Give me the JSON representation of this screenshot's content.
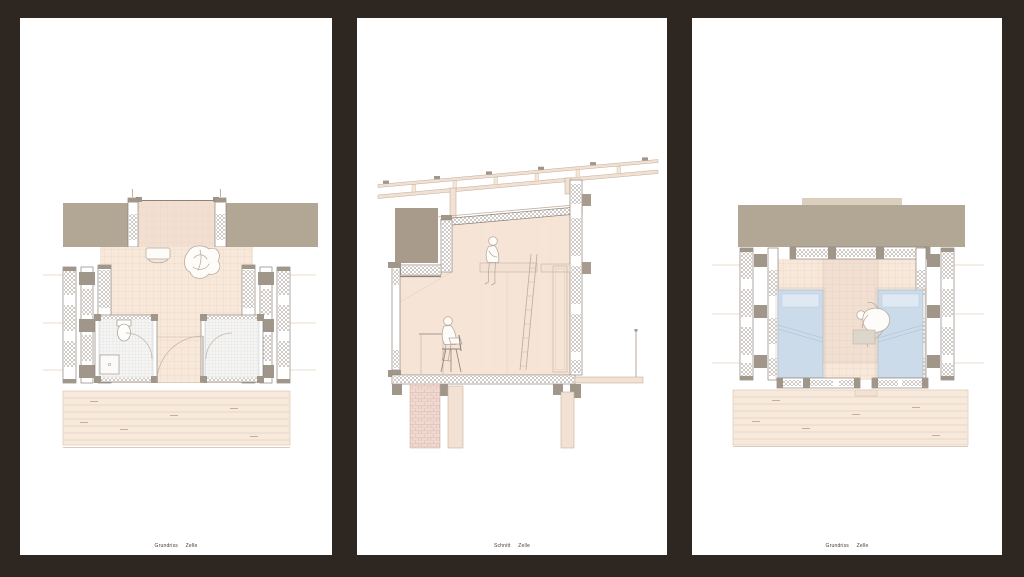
{
  "board": {
    "background_color": "#2E2721",
    "panel_color": "#FFFFFF"
  },
  "panels": [
    {
      "caption_type": "Grundriss",
      "caption_subject": "Zelle",
      "drawing": "ground-floor-plan"
    },
    {
      "caption_type": "Schnitt",
      "caption_subject": "Zelle",
      "drawing": "cross-section"
    },
    {
      "caption_type": "Grundriss",
      "caption_subject": "Zelle",
      "drawing": "sleeping-level-floor-plan"
    }
  ],
  "colors": {
    "background": "#2E2721",
    "panel": "#FFFFFF",
    "roof-taupe": "#B2A695",
    "taupe-dark": "#A89B8B",
    "ridge-tan": "#DBCFBD",
    "floor-peach": "#F7E8DA",
    "floor-peach-dark": "#F1DFD1",
    "deck-peach": "#F7E9DB",
    "wall-line": "#8D8278",
    "line-light": "#C4B1A0",
    "post-gray": "#A1968A",
    "bed-blue": "#CBDBEA",
    "pillow-blue": "#DFE9F3",
    "brick": "#F0D9D1",
    "brick-line": "#D7B0A6",
    "caption-text": "#413C38"
  }
}
